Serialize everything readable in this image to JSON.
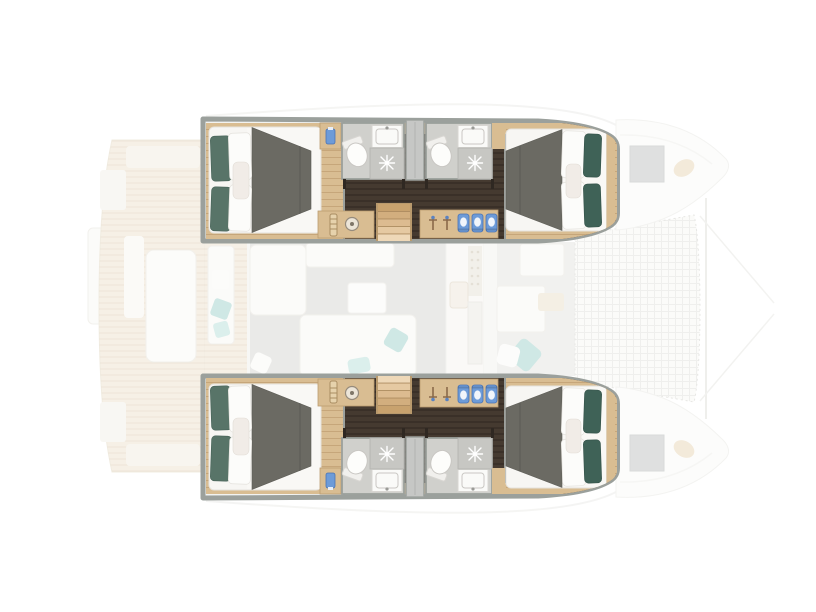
{
  "figure": {
    "type": "yacht-floorplan",
    "vessel": "catamaran",
    "view": "top-down",
    "bow_direction": "right",
    "stern_direction": "left",
    "cabins_highlighted": 4,
    "bathrooms_highlighted": 4,
    "double_beds": 4,
    "companionway_stairs": 2
  },
  "zones": {
    "highlighted": [
      "port-aft-cabin",
      "port-forward-cabin",
      "port-aft-bathroom",
      "port-forward-bathroom",
      "port-wardrobe",
      "port-corridor",
      "port-companionway-stairs",
      "port-vanity",
      "starboard-aft-cabin",
      "starboard-forward-cabin",
      "starboard-aft-bathroom",
      "starboard-forward-bathroom",
      "starboard-wardrobe",
      "starboard-corridor",
      "starboard-companionway-stairs",
      "starboard-vanity"
    ],
    "faded": [
      "swim-platform",
      "aft-deck",
      "cockpit-table",
      "cockpit-bench",
      "salon-sofa",
      "salon-rug",
      "galley",
      "forward-cockpit",
      "trampoline",
      "bow-hatches"
    ]
  },
  "colors": {
    "canvas": "#ffffff",
    "wall": "#9ba09c",
    "hull_lining": "#f2f3f1",
    "wood": "#d9bd92",
    "wood_line": "#bb9c70",
    "floor_dark": "#453a30",
    "mattress": "#f7f6f3",
    "duvet": "#f9f8f5",
    "blanket": "#6b6a63",
    "pillow_teal": "#587468",
    "pillow_teal_dark": "#3f6257",
    "pillow_white": "#fcfcfa",
    "bath_floor": "#d0d0cc",
    "shower": "#c7c7c3",
    "fixture": "#fdfdfb",
    "closet": "#c6c7c5",
    "accent_blue": "#6d9bd8",
    "faded_white": "#f9f8f5",
    "faded_deck": "#efe5d3",
    "faded_rug": "#dadad6",
    "faded_teal": "#a9d6d0",
    "faded_floor": "#e7e6e2"
  }
}
